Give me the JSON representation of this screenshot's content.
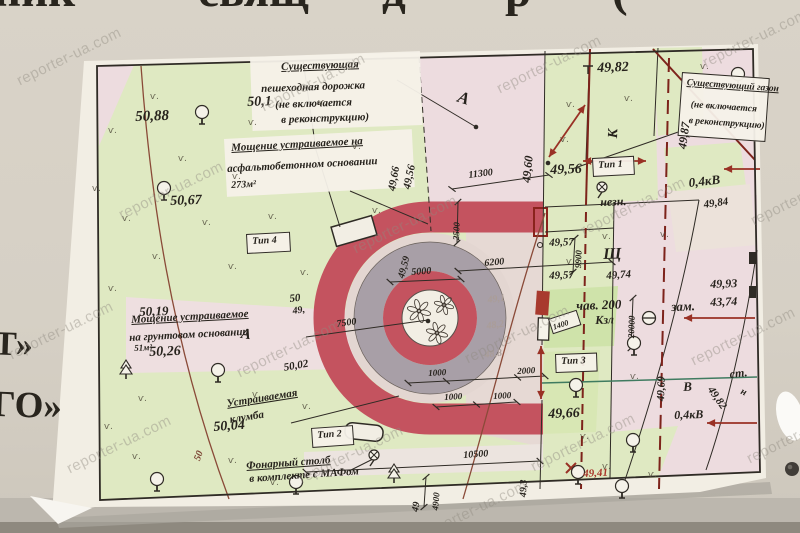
{
  "photo": {
    "watermark_text": "reporter-ua.com",
    "banner_top_fragments": [
      "ник",
      "свящ",
      "д",
      "р",
      "("
    ],
    "banner_left_lines": [
      "Т»",
      "ГО»"
    ]
  },
  "colors": {
    "paper": "#f2eee4",
    "green": "#dfe9c2",
    "green_bright": "#cfe3aa",
    "pink": "#eddcdf",
    "pale": "#e6d9d4",
    "red_paving": "#c4535f",
    "gray_ring": "#a89fa7",
    "ink": "#26221c",
    "red_line": "#993125",
    "brown": "#8a4a38",
    "teal": "#3f7b60"
  },
  "plan": {
    "symbols": {
      "grass_mark": "ѵ.",
      "icon_names": [
        "tree-icon",
        "conifer-icon",
        "lamp-icon",
        "manhole-icon",
        "grass-icon"
      ]
    },
    "boxes": [
      {
        "x": 250,
        "y": 57,
        "w": 170,
        "h": 74,
        "rot": -2,
        "bordered": 0,
        "name": "callout-existing-path-box"
      },
      {
        "x": 224,
        "y": 139,
        "w": 188,
        "h": 58,
        "rot": -3,
        "bordered": 0,
        "name": "callout-asphalt-box"
      },
      {
        "x": 682,
        "y": 72,
        "w": 86,
        "h": 62,
        "rot": 4,
        "bordered": 1,
        "name": "callout-lawn-box"
      },
      {
        "x": 592,
        "y": 158,
        "w": 40,
        "h": 17,
        "rot": -3,
        "bordered": 1,
        "name": "type-1-box"
      },
      {
        "x": 311,
        "y": 428,
        "w": 40,
        "h": 18,
        "rot": -4,
        "bordered": 1,
        "name": "type-2-box"
      },
      {
        "x": 555,
        "y": 354,
        "w": 40,
        "h": 17,
        "rot": -2,
        "bordered": 1,
        "name": "type-3-box"
      },
      {
        "x": 246,
        "y": 234,
        "w": 42,
        "h": 18,
        "rot": -3,
        "bordered": 1,
        "name": "type-4-box"
      },
      {
        "x": 548,
        "y": 319,
        "w": 28,
        "h": 14,
        "rot": -18,
        "bordered": 1,
        "name": "dim-1400-box"
      }
    ],
    "labels": [
      {
        "t": "Существующая",
        "x": 281,
        "y": 62,
        "fs": 11,
        "rot": -2,
        "u": 1,
        "name": "callout-existing-path-line1"
      },
      {
        "t": "пешеходная дорожка",
        "x": 261,
        "y": 84,
        "fs": 11,
        "rot": -2,
        "name": "callout-existing-path-line2"
      },
      {
        "t": "(не включается",
        "x": 275,
        "y": 100,
        "fs": 11,
        "rot": -2,
        "name": "callout-existing-path-line3"
      },
      {
        "t": "в реконструкцию)",
        "x": 281,
        "y": 115,
        "fs": 11,
        "rot": -2,
        "name": "callout-existing-path-line4"
      },
      {
        "t": "Мощение устраиваемое на",
        "x": 231,
        "y": 143,
        "fs": 11,
        "rot": -3,
        "u": 1,
        "name": "callout-asphalt-line1"
      },
      {
        "t": "асфальтобетонном основании",
        "x": 227,
        "y": 164,
        "fs": 11,
        "rot": -3,
        "name": "callout-asphalt-line2"
      },
      {
        "t": "273м²",
        "x": 231,
        "y": 181,
        "fs": 10,
        "rot": -3,
        "name": "callout-asphalt-line3"
      },
      {
        "t": "Мощение устраиваемое",
        "x": 131,
        "y": 315,
        "fs": 11,
        "rot": -3,
        "u": 1,
        "name": "callout-ground-line1"
      },
      {
        "t": "на грунтовом основании",
        "x": 129,
        "y": 333,
        "fs": 11,
        "rot": -3,
        "name": "callout-ground-line2"
      },
      {
        "t": "51м²",
        "x": 134,
        "y": 344,
        "fs": 9,
        "rot": -3,
        "name": "callout-ground-line3"
      },
      {
        "t": "Устраиваемая",
        "x": 226,
        "y": 399,
        "fs": 11,
        "rot": -9,
        "u": 1,
        "name": "callout-flowerbed-line1"
      },
      {
        "t": "клумба",
        "x": 229,
        "y": 415,
        "fs": 11,
        "rot": -9,
        "name": "callout-flowerbed-line2"
      },
      {
        "t": "Фонарный столб",
        "x": 246,
        "y": 461,
        "fs": 11,
        "rot": -4,
        "u": 1,
        "name": "callout-lamppost-line1"
      },
      {
        "t": "в комплекте с МАФом",
        "x": 249,
        "y": 474,
        "fs": 11,
        "rot": -4,
        "name": "callout-lamppost-line2"
      },
      {
        "t": "Существующий газон",
        "x": 687,
        "y": 79,
        "fs": 9.5,
        "rot": 4,
        "u": 1,
        "name": "callout-lawn-line1"
      },
      {
        "t": "(не включается",
        "x": 691,
        "y": 101,
        "fs": 9.5,
        "rot": 4,
        "name": "callout-lawn-line2"
      },
      {
        "t": "в реконструкцию)",
        "x": 689,
        "y": 117,
        "fs": 9.5,
        "rot": 4,
        "name": "callout-lawn-line3"
      },
      {
        "t": "Тип 1",
        "x": 598,
        "y": 161,
        "fs": 10,
        "rot": -3,
        "name": "type-1-label"
      },
      {
        "t": "Тип 2",
        "x": 317,
        "y": 431,
        "fs": 10,
        "rot": -4,
        "name": "type-2-label"
      },
      {
        "t": "Тип 3",
        "x": 561,
        "y": 357,
        "fs": 10,
        "rot": -2,
        "name": "type-3-label"
      },
      {
        "t": "Тип 4",
        "x": 252,
        "y": 237,
        "fs": 10,
        "rot": -3,
        "name": "type-4-label"
      },
      {
        "t": "50,88",
        "x": 135,
        "y": 110,
        "fs": 15,
        "rot": -2,
        "name": "elevation"
      },
      {
        "t": "50,1",
        "x": 247,
        "y": 96,
        "fs": 14,
        "rot": -2,
        "name": "elevation"
      },
      {
        "t": "50,67",
        "x": 170,
        "y": 195,
        "fs": 14,
        "rot": -2,
        "name": "elevation"
      },
      {
        "t": "50,19",
        "x": 139,
        "y": 305,
        "fs": 13,
        "rot": -2,
        "name": "elevation"
      },
      {
        "t": "50,26",
        "x": 149,
        "y": 346,
        "fs": 14,
        "rot": -2,
        "name": "elevation"
      },
      {
        "t": "50,04",
        "x": 213,
        "y": 421,
        "fs": 14,
        "rot": -4,
        "name": "elevation"
      },
      {
        "t": "50,02",
        "x": 283,
        "y": 363,
        "fs": 11,
        "rot": -10,
        "name": "elevation"
      },
      {
        "t": "50",
        "x": 289,
        "y": 294,
        "fs": 11,
        "rot": -6,
        "name": "elevation"
      },
      {
        "t": "49,",
        "x": 292,
        "y": 307,
        "fs": 10,
        "rot": -8,
        "name": "elevation"
      },
      {
        "t": "49,82",
        "x": 597,
        "y": 62,
        "fs": 14,
        "rot": -2,
        "name": "elevation"
      },
      {
        "t": "49,87",
        "x": 676,
        "y": 148,
        "fs": 12,
        "rot": -82,
        "name": "elevation"
      },
      {
        "t": "49,60",
        "x": 520,
        "y": 182,
        "fs": 12,
        "rot": -84,
        "name": "elevation"
      },
      {
        "t": "49,66",
        "x": 387,
        "y": 190,
        "fs": 11,
        "rot": -80,
        "name": "elevation"
      },
      {
        "t": "49,56",
        "x": 402,
        "y": 188,
        "fs": 11,
        "rot": -78,
        "name": "elevation"
      },
      {
        "t": "49,56",
        "x": 550,
        "y": 164,
        "fs": 14,
        "rot": -2,
        "name": "elevation"
      },
      {
        "t": "49,57",
        "x": 549,
        "y": 238,
        "fs": 11,
        "rot": -2,
        "name": "elevation"
      },
      {
        "t": "49,57",
        "x": 549,
        "y": 271,
        "fs": 11,
        "rot": -2,
        "name": "elevation"
      },
      {
        "t": "49,74",
        "x": 606,
        "y": 271,
        "fs": 11,
        "rot": -4,
        "name": "elevation"
      },
      {
        "t": "49,59",
        "x": 397,
        "y": 277,
        "fs": 10,
        "rot": -75,
        "name": "elevation"
      },
      {
        "t": "49,93",
        "x": 710,
        "y": 278,
        "fs": 12,
        "rot": -2,
        "name": "elevation"
      },
      {
        "t": "43,74",
        "x": 710,
        "y": 296,
        "fs": 12,
        "rot": -2,
        "name": "elevation"
      },
      {
        "t": "49,84",
        "x": 703,
        "y": 200,
        "fs": 11,
        "rot": -8,
        "name": "elevation"
      },
      {
        "t": "49,66",
        "x": 548,
        "y": 408,
        "fs": 14,
        "rot": -2,
        "name": "elevation"
      },
      {
        "t": "49,69",
        "x": 656,
        "y": 401,
        "fs": 11,
        "rot": -88,
        "name": "elevation"
      },
      {
        "t": "49,82",
        "x": 714,
        "y": 385,
        "fs": 11,
        "rot": 55,
        "name": "elevation"
      },
      {
        "t": "49,41",
        "x": 583,
        "y": 469,
        "fs": 11,
        "rot": -3,
        "c": "red",
        "name": "elevation-red"
      },
      {
        "t": "49,3",
        "x": 519,
        "y": 497,
        "fs": 10,
        "rot": -88,
        "name": "elevation"
      },
      {
        "t": "49",
        "x": 411,
        "y": 511,
        "fs": 10,
        "rot": -80,
        "name": "elevation"
      },
      {
        "t": "49,1",
        "x": 487,
        "y": 296,
        "fs": 10,
        "rot": -8,
        "c": "faint",
        "name": "elevation-faded"
      },
      {
        "t": "48,2",
        "x": 486,
        "y": 322,
        "fs": 10,
        "rot": -8,
        "c": "faint",
        "name": "elevation-faded"
      },
      {
        "t": "48,8",
        "x": 484,
        "y": 351,
        "fs": 10,
        "rot": -8,
        "c": "faint",
        "name": "elevation-faded"
      },
      {
        "t": "А",
        "x": 461,
        "y": 88,
        "fs": 17,
        "rot": 18,
        "name": "letter-a-top"
      },
      {
        "t": "А",
        "x": 242,
        "y": 327,
        "fs": 15,
        "rot": 8,
        "name": "letter-a-mid"
      },
      {
        "t": "К",
        "x": 607,
        "y": 138,
        "fs": 14,
        "rot": -88,
        "name": "utility-letter-k"
      },
      {
        "t": "Щ",
        "x": 603,
        "y": 247,
        "fs": 16,
        "rot": -2,
        "name": "utility-letter-shch"
      },
      {
        "t": "В",
        "x": 683,
        "y": 380,
        "fs": 13,
        "rot": -2,
        "name": "utility-letter-v"
      },
      {
        "t": "незн.",
        "x": 600,
        "y": 196,
        "fs": 12,
        "rot": -2,
        "name": "note-nezn"
      },
      {
        "t": "чав. 200",
        "x": 576,
        "y": 299,
        "fs": 13,
        "rot": -2,
        "name": "note-chav-200"
      },
      {
        "t": "Кзл",
        "x": 595,
        "y": 314,
        "fs": 12,
        "rot": -2,
        "name": "note-kzl"
      },
      {
        "t": "зам.",
        "x": 671,
        "y": 300,
        "fs": 13,
        "rot": -2,
        "name": "note-zam"
      },
      {
        "t": "ст.",
        "x": 729,
        "y": 368,
        "fs": 12,
        "rot": -6,
        "name": "note-st"
      },
      {
        "t": "н",
        "x": 743,
        "y": 387,
        "fs": 10,
        "rot": 25,
        "name": "note-n"
      },
      {
        "t": "0,4кВ",
        "x": 688,
        "y": 176,
        "fs": 13,
        "rot": -6,
        "name": "power-line-04kv-top"
      },
      {
        "t": "0,4кВ",
        "x": 674,
        "y": 409,
        "fs": 12,
        "rot": -2,
        "name": "power-line-04kv-bottom"
      },
      {
        "t": "50",
        "x": 193,
        "y": 459,
        "fs": 10,
        "rot": -70,
        "c": "brown",
        "name": "contour-label-50"
      },
      {
        "t": "11300",
        "x": 468,
        "y": 171,
        "fs": 10,
        "rot": -7,
        "name": "dimension"
      },
      {
        "t": "5000",
        "x": 411,
        "y": 268,
        "fs": 10,
        "rot": -4,
        "name": "dimension"
      },
      {
        "t": "6200",
        "x": 484,
        "y": 259,
        "fs": 10,
        "rot": -5,
        "name": "dimension"
      },
      {
        "t": "7500",
        "x": 336,
        "y": 320,
        "fs": 10,
        "rot": -8,
        "name": "dimension"
      },
      {
        "t": "2500",
        "x": 452,
        "y": 240,
        "fs": 9,
        "rot": -88,
        "name": "dimension"
      },
      {
        "t": "1000",
        "x": 428,
        "y": 369,
        "fs": 9,
        "rot": -3,
        "name": "dimension"
      },
      {
        "t": "2000",
        "x": 517,
        "y": 367,
        "fs": 9,
        "rot": -3,
        "name": "dimension"
      },
      {
        "t": "1000",
        "x": 444,
        "y": 393,
        "fs": 9,
        "rot": -3,
        "name": "dimension"
      },
      {
        "t": "1000",
        "x": 493,
        "y": 392,
        "fs": 9,
        "rot": -3,
        "name": "dimension"
      },
      {
        "t": "10500",
        "x": 463,
        "y": 451,
        "fs": 10,
        "rot": -4,
        "name": "dimension"
      },
      {
        "t": "9900",
        "x": 574,
        "y": 268,
        "fs": 9,
        "rot": -88,
        "name": "dimension"
      },
      {
        "t": "20000",
        "x": 627,
        "y": 338,
        "fs": 9,
        "rot": -88,
        "name": "dimension"
      },
      {
        "t": "1400",
        "x": 552,
        "y": 324,
        "fs": 8,
        "rot": -18,
        "name": "dimension"
      },
      {
        "t": "4900",
        "x": 431,
        "y": 510,
        "fs": 9,
        "rot": -85,
        "name": "dimension"
      }
    ]
  }
}
